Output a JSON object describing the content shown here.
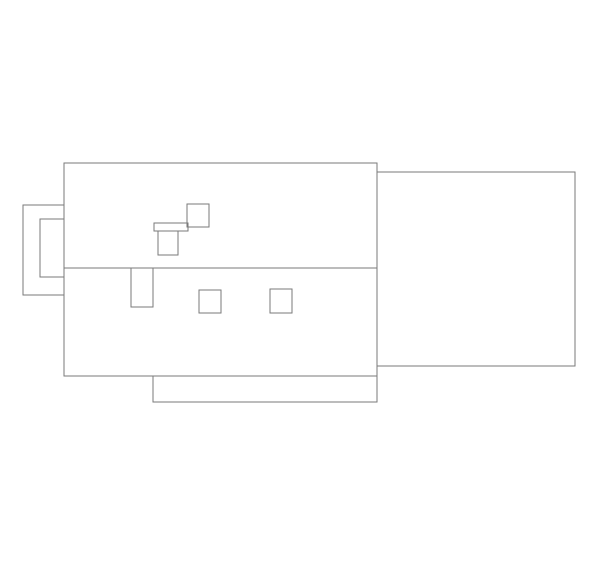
{
  "canvas": {
    "width": 600,
    "height": 569,
    "background_color": "#ffffff",
    "stroke_color": "#7a7a7a",
    "stroke_width": 1
  },
  "drawing": {
    "description": "technical-outline-drawing",
    "shapes": [
      {
        "name": "main-body-outline",
        "type": "rect",
        "x": 64,
        "y": 163,
        "w": 313,
        "h": 213
      },
      {
        "name": "horizontal-divider-line",
        "type": "line",
        "x1": 64,
        "y1": 268,
        "x2": 377,
        "y2": 268
      },
      {
        "name": "right-extension-outline",
        "type": "rect",
        "x": 377,
        "y": 172,
        "w": 198,
        "h": 194
      },
      {
        "name": "left-tab-outer-outline",
        "type": "rect",
        "x": 23,
        "y": 205,
        "w": 41,
        "h": 90
      },
      {
        "name": "left-tab-inner-outline",
        "type": "rect",
        "x": 40,
        "y": 219,
        "w": 24,
        "h": 58
      },
      {
        "name": "upper-small-square",
        "type": "rect",
        "x": 187,
        "y": 204,
        "w": 22,
        "h": 23
      },
      {
        "name": "horizontal-bar",
        "type": "rect",
        "x": 154,
        "y": 223,
        "w": 34,
        "h": 8
      },
      {
        "name": "vertical-slot-upper",
        "type": "rect",
        "x": 158,
        "y": 231,
        "w": 20,
        "h": 24
      },
      {
        "name": "vertical-slot-lower",
        "type": "rect",
        "x": 131,
        "y": 268,
        "w": 22,
        "h": 39
      },
      {
        "name": "small-square-left",
        "type": "rect",
        "x": 199,
        "y": 290,
        "w": 22,
        "h": 23
      },
      {
        "name": "small-square-right",
        "type": "rect",
        "x": 270,
        "y": 289,
        "w": 22,
        "h": 24
      },
      {
        "name": "bottom-tab-outline",
        "type": "rect",
        "x": 153,
        "y": 376,
        "w": 224,
        "h": 26
      }
    ]
  }
}
